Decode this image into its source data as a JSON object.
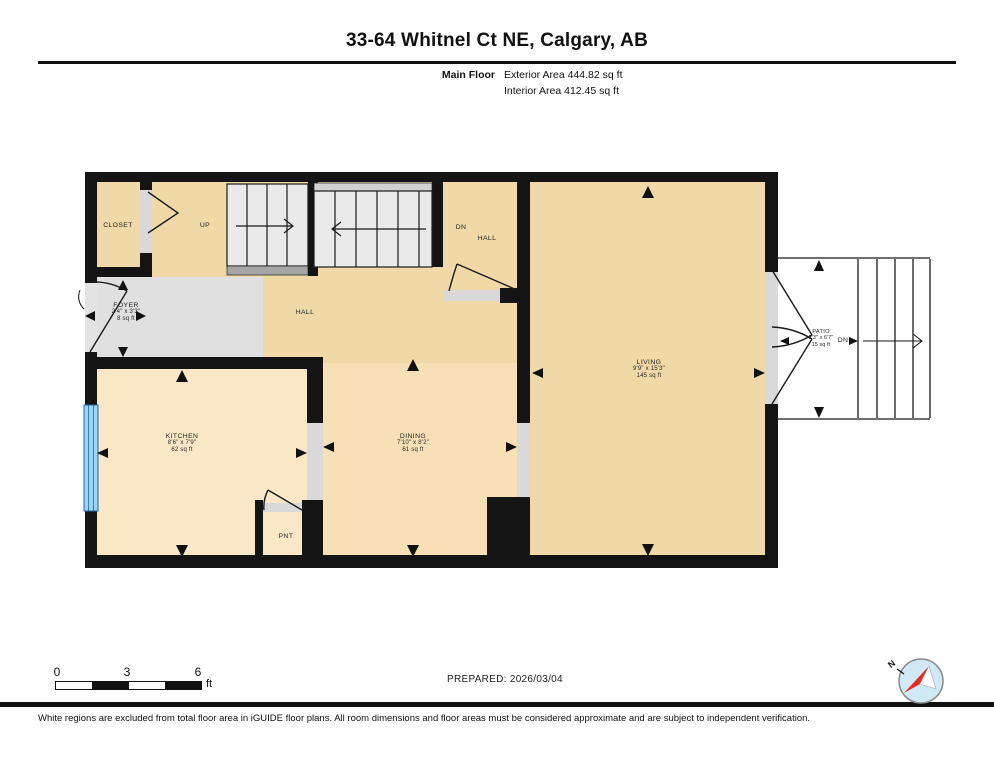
{
  "header": {
    "title": "33-64 Whitnel Ct NE, Calgary, AB",
    "floor_label": "Main Floor",
    "exterior_area": "Exterior Area 444.82 sq ft",
    "interior_area": "Interior Area 412.45 sq ft"
  },
  "rooms": {
    "closet": {
      "name": "CLOSET"
    },
    "stairs_up": {
      "label": "UP"
    },
    "dn_hall": {
      "dn": "DN",
      "name": "HALL"
    },
    "hall": {
      "name": "HALL"
    },
    "foyer": {
      "name": "FOYER",
      "dims": "2'4\" x 3'3\"",
      "area": "8 sq ft"
    },
    "kitchen": {
      "name": "KITCHEN",
      "dims": "8'6\" x 7'9\"",
      "area": "62 sq ft"
    },
    "dining": {
      "name": "DINING",
      "dims": "7'10\" x 8'2\"",
      "area": "61 sq ft"
    },
    "living": {
      "name": "LIVING",
      "dims": "9'9\" x 15'3\"",
      "area": "145 sq ft"
    },
    "pantry": {
      "name": "PNT"
    },
    "patio": {
      "name": "PATIO",
      "dims": "2'3\" x 6'7\"",
      "area": "15 sq ft",
      "dn": "DN"
    }
  },
  "scale_bar": {
    "tick_0": "0",
    "tick_3": "3",
    "tick_6": "6",
    "unit": "ft"
  },
  "footer": {
    "prepared": "PREPARED: 2026/03/04",
    "compass_n": "N",
    "disclaimer": "White regions are excluded from total floor area in iGUIDE floor plans. All room dimensions and floor areas must be considered approximate and are subject to independent verification."
  },
  "colors": {
    "wall": "#141414",
    "floor_tan": "#f1d9a7",
    "floor_light": "#fae7c5",
    "foyer_gray": "#e0e0e0",
    "window_blue": "#9bd4f5",
    "compass_red": "#e8291c"
  }
}
